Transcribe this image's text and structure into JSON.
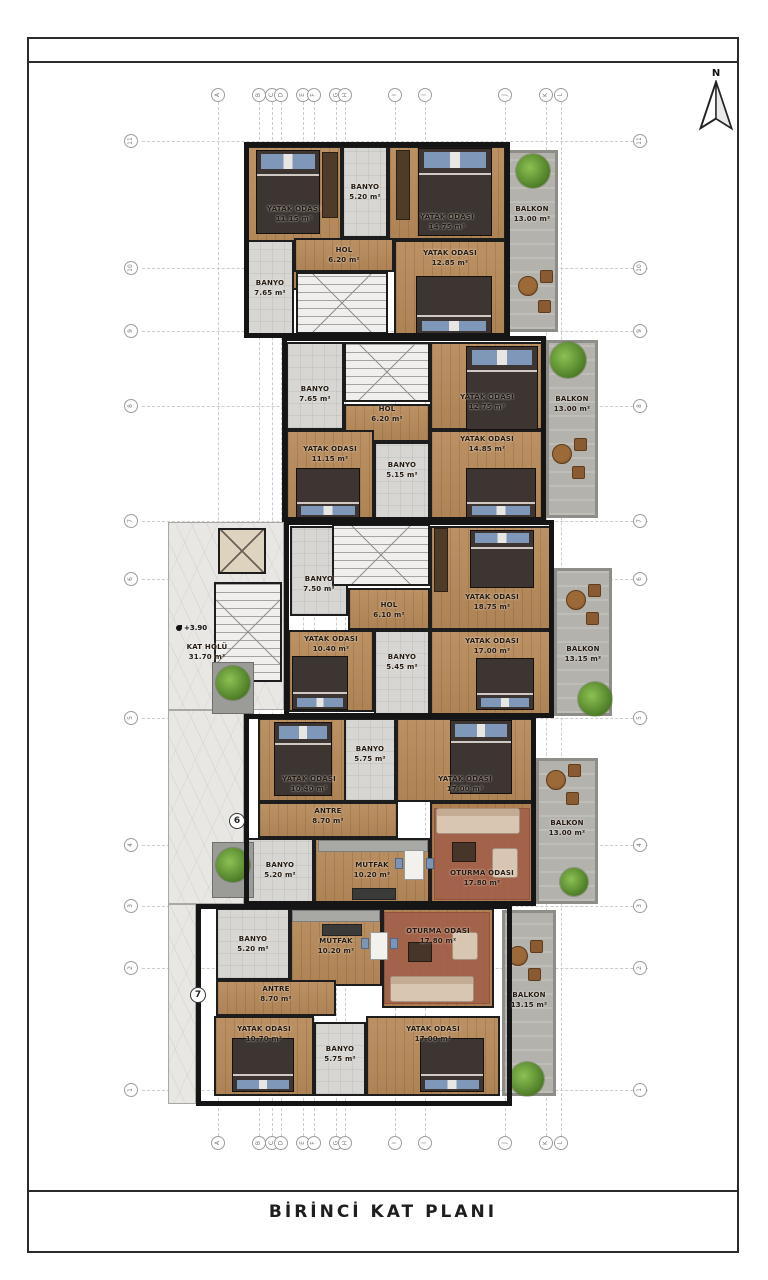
{
  "title": "BİRİNCİ KAT PLANI",
  "north_label": "N",
  "colors": {
    "wall": "#151515",
    "wood": "#b78a5a",
    "tile": "#d7d6d2",
    "balcony": "#b4b2ac",
    "plant": "#6fae3e",
    "rug": "#a2604a",
    "pillow": "#7f97b8"
  },
  "grid": {
    "columns": [
      {
        "label": "A",
        "x": 218
      },
      {
        "label": "B",
        "x": 259
      },
      {
        "label": "C",
        "x": 272
      },
      {
        "label": "D",
        "x": 281
      },
      {
        "label": "E",
        "x": 303
      },
      {
        "label": "F",
        "x": 314
      },
      {
        "label": "G",
        "x": 336
      },
      {
        "label": "H",
        "x": 345
      },
      {
        "label": "I",
        "x": 395
      },
      {
        "label": "İ",
        "x": 425
      },
      {
        "label": "J",
        "x": 505
      },
      {
        "label": "K",
        "x": 546
      },
      {
        "label": "L",
        "x": 561
      }
    ],
    "rows": [
      {
        "label": "11",
        "y": 141
      },
      {
        "label": "10",
        "y": 268
      },
      {
        "label": "9",
        "y": 331
      },
      {
        "label": "8",
        "y": 406
      },
      {
        "label": "7",
        "y": 521
      },
      {
        "label": "6",
        "y": 579
      },
      {
        "label": "5",
        "y": 718
      },
      {
        "label": "4",
        "y": 845
      },
      {
        "label": "3",
        "y": 906
      },
      {
        "label": "2",
        "y": 968
      },
      {
        "label": "1",
        "y": 1090
      }
    ]
  },
  "plan": {
    "level_marker": "+3.90",
    "unit_badges": [
      {
        "label": "6",
        "x": 229,
        "y": 813
      },
      {
        "label": "7",
        "x": 190,
        "y": 987
      }
    ],
    "blocks": [
      {
        "x": 244,
        "y": 142,
        "w": 266,
        "h": 196
      },
      {
        "x": 282,
        "y": 336,
        "w": 264,
        "h": 186
      },
      {
        "x": 284,
        "y": 520,
        "w": 270,
        "h": 198
      },
      {
        "x": 244,
        "y": 714,
        "w": 292,
        "h": 192
      },
      {
        "x": 196,
        "y": 904,
        "w": 316,
        "h": 202
      }
    ],
    "rooms": [
      {
        "unit": 1,
        "name": "YATAK ODASI",
        "area": "11.15 m²",
        "x": 246,
        "y": 146,
        "w": 96,
        "h": 144,
        "floor": "wood",
        "ly": 214
      },
      {
        "unit": 1,
        "name": "BANYO",
        "area": "5.20 m²",
        "x": 342,
        "y": 146,
        "w": 46,
        "h": 92,
        "floor": "tile"
      },
      {
        "unit": 1,
        "name": "YATAK ODASI",
        "area": "14.75 m²",
        "x": 388,
        "y": 146,
        "w": 118,
        "h": 94,
        "floor": "wood",
        "ly": 222
      },
      {
        "unit": 1,
        "name": "BALKON",
        "area": "13.00 m²",
        "x": 506,
        "y": 150,
        "w": 52,
        "h": 182,
        "floor": "balcony",
        "ly": 214
      },
      {
        "unit": 1,
        "name": "HOL",
        "area": "6.20 m²",
        "x": 294,
        "y": 238,
        "w": 100,
        "h": 34,
        "floor": "wood"
      },
      {
        "unit": 1,
        "name": "BANYO",
        "area": "7.65 m²",
        "x": 246,
        "y": 240,
        "w": 48,
        "h": 96,
        "floor": "tile"
      },
      {
        "unit": 1,
        "name": "YATAK ODASI",
        "area": "12.85 m²",
        "x": 394,
        "y": 240,
        "w": 112,
        "h": 96,
        "floor": "wood",
        "ly": 258
      },
      {
        "unit": 2,
        "name": "BANYO",
        "area": "7.65 m²",
        "x": 286,
        "y": 342,
        "w": 58,
        "h": 88,
        "floor": "tile",
        "ly": 394
      },
      {
        "unit": 2,
        "name": "HOL",
        "area": "6.20 m²",
        "x": 344,
        "y": 404,
        "w": 86,
        "h": 38,
        "floor": "wood",
        "ly": 414
      },
      {
        "unit": 2,
        "name": "YATAK ODASI",
        "area": "12.75 m²",
        "x": 430,
        "y": 342,
        "w": 114,
        "h": 88,
        "floor": "wood",
        "ly": 402
      },
      {
        "unit": 2,
        "name": "BALKON",
        "area": "13.00 m²",
        "x": 546,
        "y": 340,
        "w": 52,
        "h": 178,
        "floor": "balcony",
        "ly": 404
      },
      {
        "unit": 2,
        "name": "YATAK ODASI",
        "area": "11.15 m²",
        "x": 286,
        "y": 430,
        "w": 88,
        "h": 90,
        "floor": "wood",
        "ly": 454
      },
      {
        "unit": 2,
        "name": "BANYO",
        "area": "5.15 m²",
        "x": 374,
        "y": 442,
        "w": 56,
        "h": 78,
        "floor": "tile",
        "ly": 470
      },
      {
        "unit": 2,
        "name": "YATAK ODASI",
        "area": "14.85 m²",
        "x": 430,
        "y": 430,
        "w": 114,
        "h": 90,
        "floor": "wood",
        "ly": 444
      },
      {
        "unit": 3,
        "name": "BANYO",
        "area": "7.50 m²",
        "x": 290,
        "y": 526,
        "w": 58,
        "h": 90,
        "floor": "tile",
        "ly": 584
      },
      {
        "unit": 3,
        "name": "HOL",
        "area": "6.10 m²",
        "x": 348,
        "y": 588,
        "w": 82,
        "h": 42,
        "floor": "wood",
        "ly": 610
      },
      {
        "unit": 3,
        "name": "YATAK ODASI",
        "area": "18.75 m²",
        "x": 430,
        "y": 526,
        "w": 124,
        "h": 104,
        "floor": "wood",
        "ly": 602
      },
      {
        "unit": 3,
        "name": "YATAK ODASI",
        "area": "10.40 m²",
        "x": 288,
        "y": 630,
        "w": 86,
        "h": 82,
        "floor": "wood",
        "ly": 644
      },
      {
        "unit": 3,
        "name": "BANYO",
        "area": "5.45 m²",
        "x": 374,
        "y": 630,
        "w": 56,
        "h": 86,
        "floor": "tile",
        "ly": 662
      },
      {
        "unit": 3,
        "name": "YATAK ODASI",
        "area": "17.00 m²",
        "x": 430,
        "y": 630,
        "w": 124,
        "h": 86,
        "floor": "wood",
        "ly": 646
      },
      {
        "unit": 3,
        "name": "BALKON",
        "area": "13.15 m²",
        "x": 554,
        "y": 568,
        "w": 58,
        "h": 148,
        "floor": "balcony",
        "ly": 654
      },
      {
        "unit": 0,
        "name": "KAT HOLÜ",
        "area": "31.70 m²",
        "x": 168,
        "y": 522,
        "w": 116,
        "h": 188,
        "floor": "marble",
        "lx": 207,
        "ly": 652
      },
      {
        "unit": 0,
        "name": "",
        "area": "",
        "x": 168,
        "y": 710,
        "w": 76,
        "h": 194,
        "floor": "marble"
      },
      {
        "unit": 0,
        "name": "",
        "area": "",
        "x": 168,
        "y": 904,
        "w": 28,
        "h": 200,
        "floor": "marble"
      },
      {
        "unit": 4,
        "name": "YATAK ODASI",
        "area": "10.40 m²",
        "x": 258,
        "y": 718,
        "w": 102,
        "h": 84,
        "floor": "wood",
        "ly": 784
      },
      {
        "unit": 4,
        "name": "BANYO",
        "area": "5.75 m²",
        "x": 344,
        "y": 718,
        "w": 52,
        "h": 84,
        "floor": "tile",
        "ly": 754
      },
      {
        "unit": 4,
        "name": "YATAK ODASI",
        "area": "17.00 m²",
        "x": 396,
        "y": 718,
        "w": 138,
        "h": 84,
        "floor": "wood",
        "ly": 784
      },
      {
        "unit": 4,
        "name": "ANTRE",
        "area": "8.70 m²",
        "x": 258,
        "y": 802,
        "w": 140,
        "h": 36,
        "floor": "wood",
        "ly": 816
      },
      {
        "unit": 4,
        "name": "BANYO",
        "area": "5.20 m²",
        "x": 246,
        "y": 838,
        "w": 68,
        "h": 66,
        "floor": "tile",
        "ly": 870
      },
      {
        "unit": 4,
        "name": "MUTFAK",
        "area": "10.20 m²",
        "x": 314,
        "y": 838,
        "w": 116,
        "h": 66,
        "floor": "wood",
        "ly": 870
      },
      {
        "unit": 4,
        "name": "OTURMA ODASI",
        "area": "17.80 m²",
        "x": 430,
        "y": 802,
        "w": 104,
        "h": 102,
        "floor": "living",
        "ly": 878
      },
      {
        "unit": 4,
        "name": "BALKON",
        "area": "13.00 m²",
        "x": 536,
        "y": 758,
        "w": 62,
        "h": 146,
        "floor": "balcony",
        "ly": 828
      },
      {
        "unit": 5,
        "name": "BANYO",
        "area": "5.20 m²",
        "x": 216,
        "y": 908,
        "w": 74,
        "h": 72,
        "floor": "tile",
        "ly": 944
      },
      {
        "unit": 5,
        "name": "MUTFAK",
        "area": "10.20 m²",
        "x": 290,
        "y": 908,
        "w": 92,
        "h": 78,
        "floor": "wood",
        "ly": 946
      },
      {
        "unit": 5,
        "name": "OTURMA ODASI",
        "area": "17.80 m²",
        "x": 382,
        "y": 908,
        "w": 112,
        "h": 100,
        "floor": "living",
        "ly": 936
      },
      {
        "unit": 5,
        "name": "ANTRE",
        "area": "8.70 m²",
        "x": 216,
        "y": 980,
        "w": 120,
        "h": 36,
        "floor": "wood",
        "ly": 994
      },
      {
        "unit": 5,
        "name": "YATAK ODASI",
        "area": "10.70 m²",
        "x": 214,
        "y": 1016,
        "w": 100,
        "h": 80,
        "floor": "wood",
        "ly": 1034
      },
      {
        "unit": 5,
        "name": "BANYO",
        "area": "5.75 m²",
        "x": 314,
        "y": 1022,
        "w": 52,
        "h": 74,
        "floor": "tile",
        "ly": 1054
      },
      {
        "unit": 5,
        "name": "YATAK ODASI",
        "area": "17.00 m²",
        "x": 366,
        "y": 1016,
        "w": 134,
        "h": 80,
        "floor": "wood",
        "ly": 1034
      },
      {
        "unit": 5,
        "name": "BALKON",
        "area": "13.15 m²",
        "x": 502,
        "y": 910,
        "w": 54,
        "h": 186,
        "floor": "balcony",
        "ly": 1000
      }
    ],
    "furniture": [
      {
        "type": "stairs",
        "x": 296,
        "y": 272,
        "w": 92,
        "h": 62
      },
      {
        "type": "stairs",
        "x": 344,
        "y": 342,
        "w": 86,
        "h": 60
      },
      {
        "type": "stairs",
        "x": 332,
        "y": 524,
        "w": 98,
        "h": 62
      },
      {
        "type": "stairs",
        "x": 214,
        "y": 582,
        "w": 68,
        "h": 100
      },
      {
        "type": "elevator",
        "x": 218,
        "y": 528,
        "w": 48,
        "h": 46
      },
      {
        "type": "bed",
        "x": 256,
        "y": 150,
        "w": 64,
        "h": 84
      },
      {
        "type": "bed",
        "x": 418,
        "y": 148,
        "w": 74,
        "h": 88
      },
      {
        "type": "bed",
        "x": 416,
        "y": 276,
        "w": 76,
        "h": 58,
        "rot": 180
      },
      {
        "type": "bed",
        "x": 466,
        "y": 346,
        "w": 72,
        "h": 84
      },
      {
        "type": "bed",
        "x": 296,
        "y": 468,
        "w": 64,
        "h": 50,
        "rot": 180
      },
      {
        "type": "bed",
        "x": 466,
        "y": 468,
        "w": 70,
        "h": 50,
        "rot": 180
      },
      {
        "type": "bed",
        "x": 470,
        "y": 530,
        "w": 64,
        "h": 58
      },
      {
        "type": "bed",
        "x": 292,
        "y": 656,
        "w": 56,
        "h": 54,
        "rot": 180
      },
      {
        "type": "bed",
        "x": 476,
        "y": 658,
        "w": 58,
        "h": 52,
        "rot": 180
      },
      {
        "type": "bed",
        "x": 274,
        "y": 722,
        "w": 58,
        "h": 74
      },
      {
        "type": "bed",
        "x": 450,
        "y": 720,
        "w": 62,
        "h": 74
      },
      {
        "type": "bed",
        "x": 232,
        "y": 1038,
        "w": 62,
        "h": 54,
        "rot": 180
      },
      {
        "type": "bed",
        "x": 420,
        "y": 1038,
        "w": 64,
        "h": 54,
        "rot": 180
      },
      {
        "type": "closet",
        "x": 322,
        "y": 152,
        "w": 16,
        "h": 66
      },
      {
        "type": "closet",
        "x": 396,
        "y": 150,
        "w": 14,
        "h": 70
      },
      {
        "type": "closet",
        "x": 434,
        "y": 528,
        "w": 14,
        "h": 64
      },
      {
        "type": "rug",
        "x": 434,
        "y": 808,
        "w": 96,
        "h": 92
      },
      {
        "type": "sofa",
        "x": 436,
        "y": 808,
        "w": 84,
        "h": 26
      },
      {
        "type": "armchair",
        "x": 492,
        "y": 848,
        "w": 26,
        "h": 30
      },
      {
        "type": "coffee",
        "x": 452,
        "y": 842,
        "w": 24,
        "h": 20
      },
      {
        "type": "rug",
        "x": 384,
        "y": 912,
        "w": 106,
        "h": 92
      },
      {
        "type": "sofa",
        "x": 390,
        "y": 976,
        "w": 84,
        "h": 26
      },
      {
        "type": "armchair",
        "x": 452,
        "y": 932,
        "w": 26,
        "h": 28
      },
      {
        "type": "coffee",
        "x": 408,
        "y": 942,
        "w": 24,
        "h": 20
      },
      {
        "type": "rtable",
        "x": 518,
        "y": 276,
        "d": 20
      },
      {
        "type": "chair",
        "x": 540,
        "y": 270,
        "d": 13
      },
      {
        "type": "chair",
        "x": 538,
        "y": 300,
        "d": 13
      },
      {
        "type": "rtable",
        "x": 552,
        "y": 444,
        "d": 20
      },
      {
        "type": "chair",
        "x": 574,
        "y": 438,
        "d": 13
      },
      {
        "type": "chair",
        "x": 572,
        "y": 466,
        "d": 13
      },
      {
        "type": "rtable",
        "x": 566,
        "y": 590,
        "d": 20
      },
      {
        "type": "chair",
        "x": 588,
        "y": 584,
        "d": 13
      },
      {
        "type": "chair",
        "x": 586,
        "y": 612,
        "d": 13
      },
      {
        "type": "rtable",
        "x": 546,
        "y": 770,
        "d": 20
      },
      {
        "type": "chair",
        "x": 568,
        "y": 764,
        "d": 13
      },
      {
        "type": "chair",
        "x": 566,
        "y": 792,
        "d": 13
      },
      {
        "type": "rtable",
        "x": 508,
        "y": 946,
        "d": 20
      },
      {
        "type": "chair",
        "x": 530,
        "y": 940,
        "d": 13
      },
      {
        "type": "chair",
        "x": 528,
        "y": 968,
        "d": 13
      },
      {
        "type": "plant",
        "x": 516,
        "y": 154,
        "d": 34
      },
      {
        "type": "plant",
        "x": 550,
        "y": 342,
        "d": 36
      },
      {
        "type": "plant",
        "x": 578,
        "y": 682,
        "d": 34
      },
      {
        "type": "planter",
        "x": 212,
        "y": 662,
        "w": 42,
        "h": 52
      },
      {
        "type": "plant",
        "x": 216,
        "y": 666,
        "d": 34
      },
      {
        "type": "planter",
        "x": 212,
        "y": 842,
        "w": 42,
        "h": 56
      },
      {
        "type": "plant",
        "x": 216,
        "y": 848,
        "d": 34
      },
      {
        "type": "plant",
        "x": 560,
        "y": 868,
        "d": 28
      },
      {
        "type": "plant",
        "x": 510,
        "y": 1062,
        "d": 34
      },
      {
        "type": "counter",
        "x": 318,
        "y": 840,
        "w": 110,
        "h": 12
      },
      {
        "type": "counterdark",
        "x": 352,
        "y": 888,
        "w": 44,
        "h": 12
      },
      {
        "type": "counter",
        "x": 292,
        "y": 910,
        "w": 88,
        "h": 12
      },
      {
        "type": "counterdark",
        "x": 322,
        "y": 924,
        "w": 40,
        "h": 12
      },
      {
        "type": "dining",
        "x": 404,
        "y": 850,
        "w": 20,
        "h": 30
      },
      {
        "type": "bluechair",
        "x": 395,
        "y": 858,
        "w": 8,
        "h": 11
      },
      {
        "type": "bluechair",
        "x": 426,
        "y": 858,
        "w": 8,
        "h": 11
      },
      {
        "type": "dining",
        "x": 370,
        "y": 932,
        "w": 18,
        "h": 28
      },
      {
        "type": "bluechair",
        "x": 361,
        "y": 938,
        "w": 8,
        "h": 11
      },
      {
        "type": "bluechair",
        "x": 390,
        "y": 938,
        "w": 8,
        "h": 11
      }
    ]
  }
}
